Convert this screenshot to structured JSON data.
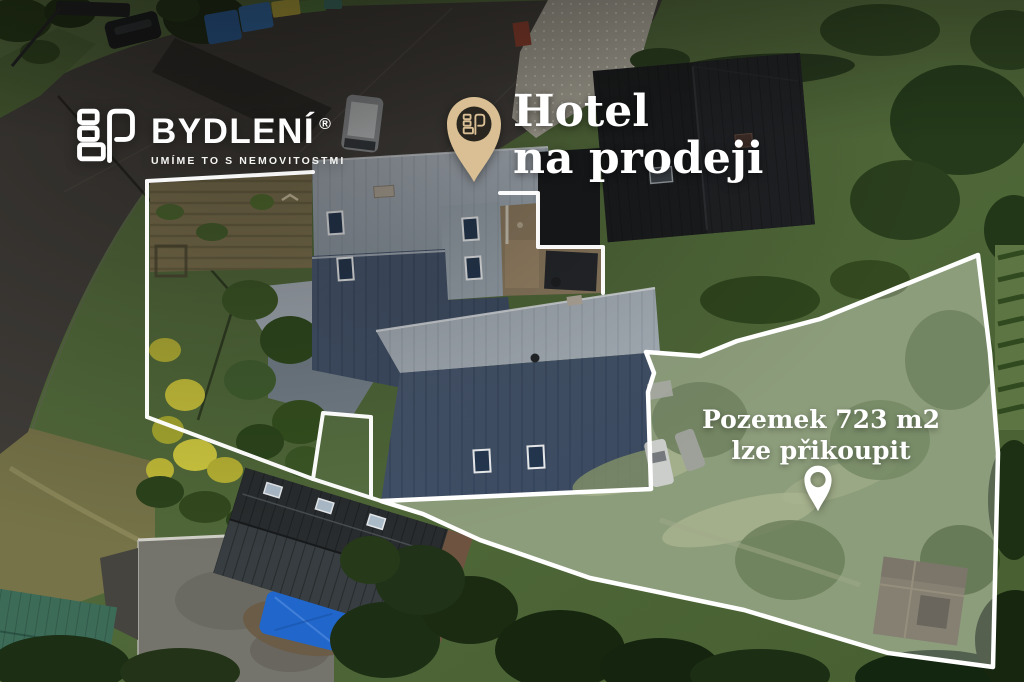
{
  "page": {
    "width_px": 1024,
    "height_px": 682,
    "kind": "aerial real-estate marketing photo"
  },
  "branding": {
    "name": "BYDLENÍ",
    "registered_mark": "®",
    "tagline": "UMÍME TO S NEMOVITOSTMI",
    "logo_icon": "bydleni-monogram-icon",
    "text_color": "#ffffff"
  },
  "listing": {
    "pin_icon": "map-pin-icon",
    "pin_color": "#d9bf93",
    "pin_inner_color": "#28261f",
    "title_line1": "Hotel",
    "title_line2": "na prodeji",
    "text_color": "#ffffff"
  },
  "land_parcel": {
    "label_line1": "Pozemek 723 m2",
    "label_line2": "lze přikoupit",
    "area_m2": 723,
    "pin_icon": "map-pin-icon",
    "pin_color": "#ffffff",
    "outline_color": "#ffffff",
    "overlay_fill": "rgba(255,255,255,0.27)"
  },
  "property_outline": {
    "color": "#ffffff"
  }
}
